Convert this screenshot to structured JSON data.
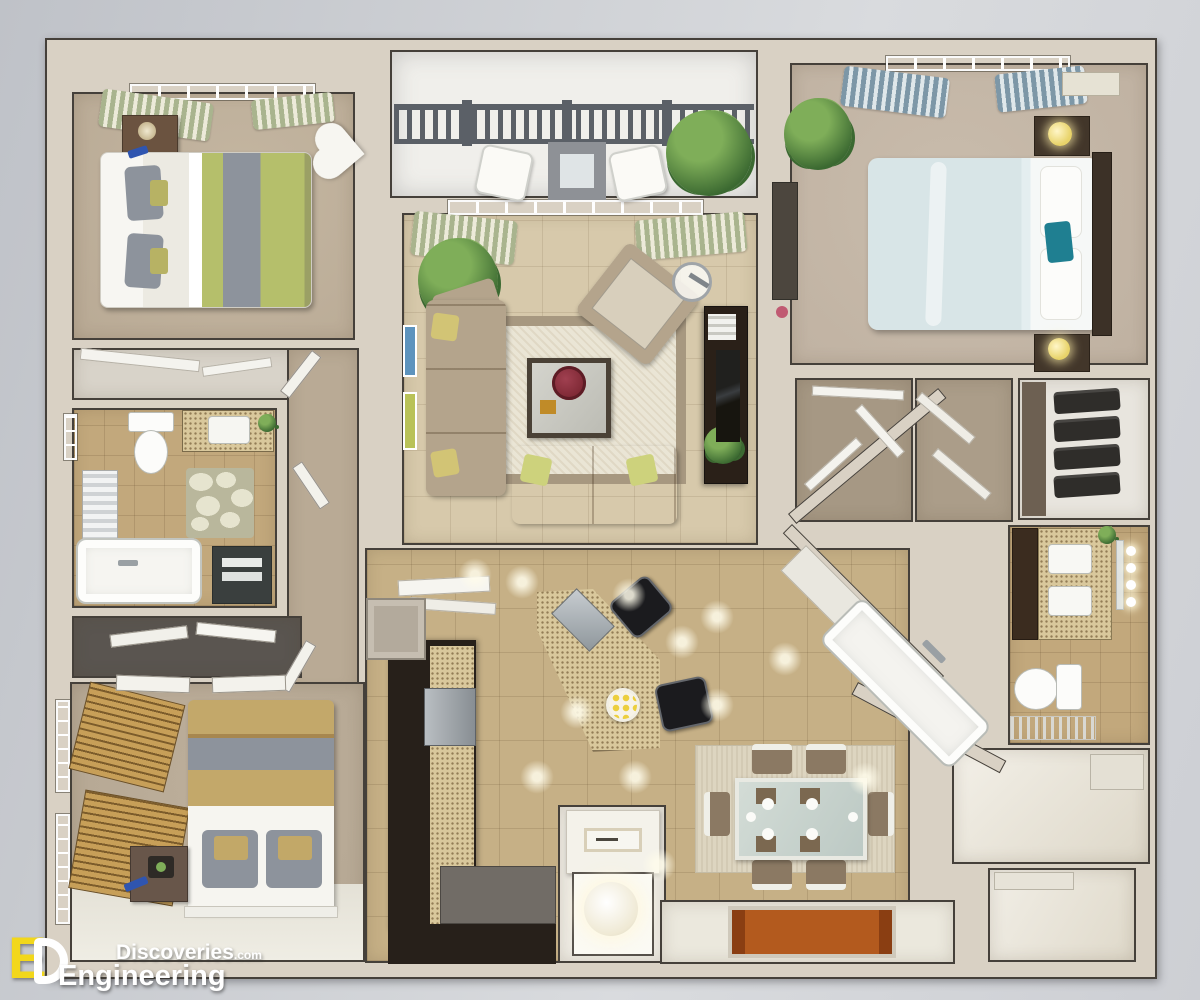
{
  "watermark": {
    "logo_letter_e": "E",
    "logo_letter_d": "D",
    "brand_word_top": "Discoveries",
    "brand_domain_suffix": ".com",
    "brand_word_bottom": "Engineering"
  },
  "colors": {
    "bg1": "#bfc2c8",
    "bg2": "#d9dbde",
    "wall": "#d9d1c4",
    "line": "#45403a",
    "carpet1": "#b9aa95",
    "carpet2": "#b3a591",
    "carpetMaster": "#bfb1a1",
    "tileLiving": "#d7c9ab",
    "tileKitchen": "#c6b086",
    "tileBath": "#c2a87c",
    "balconyFloor": "#f0efeb",
    "whiteFloor": "#ebe8dd",
    "counterDark": "#27201a",
    "speckle": "#d9c89c",
    "steel": "#9aa1a7",
    "sofa": "#b4a48c",
    "rugBorder": "#a79880",
    "rugInner": "#eae5d5",
    "tableDark": "#4a4136",
    "bowlRed": "#7c2733",
    "pillowYellow": "#d2c475",
    "bedGreen": "#b5bf6b",
    "bedGrey": "#8d939c",
    "bedGold": "#c3a86a",
    "masterBlue": "#d8e5e7",
    "teal": "#1f7f91",
    "headboard": "#3c3127",
    "curtainSage": "#a9b48e",
    "curtainBlue": "#7d97a7",
    "blindsWood": "#c79f58",
    "railing": "#5b6067",
    "stool": "#1b1b1e",
    "matOrange": "#b35a1e",
    "plantDark": "#3b6931",
    "plantLight": "#7fae59",
    "lampYellow": "#e8d36a",
    "logoYellow": "#f2d71b",
    "watermarkText": "#ffffff"
  }
}
